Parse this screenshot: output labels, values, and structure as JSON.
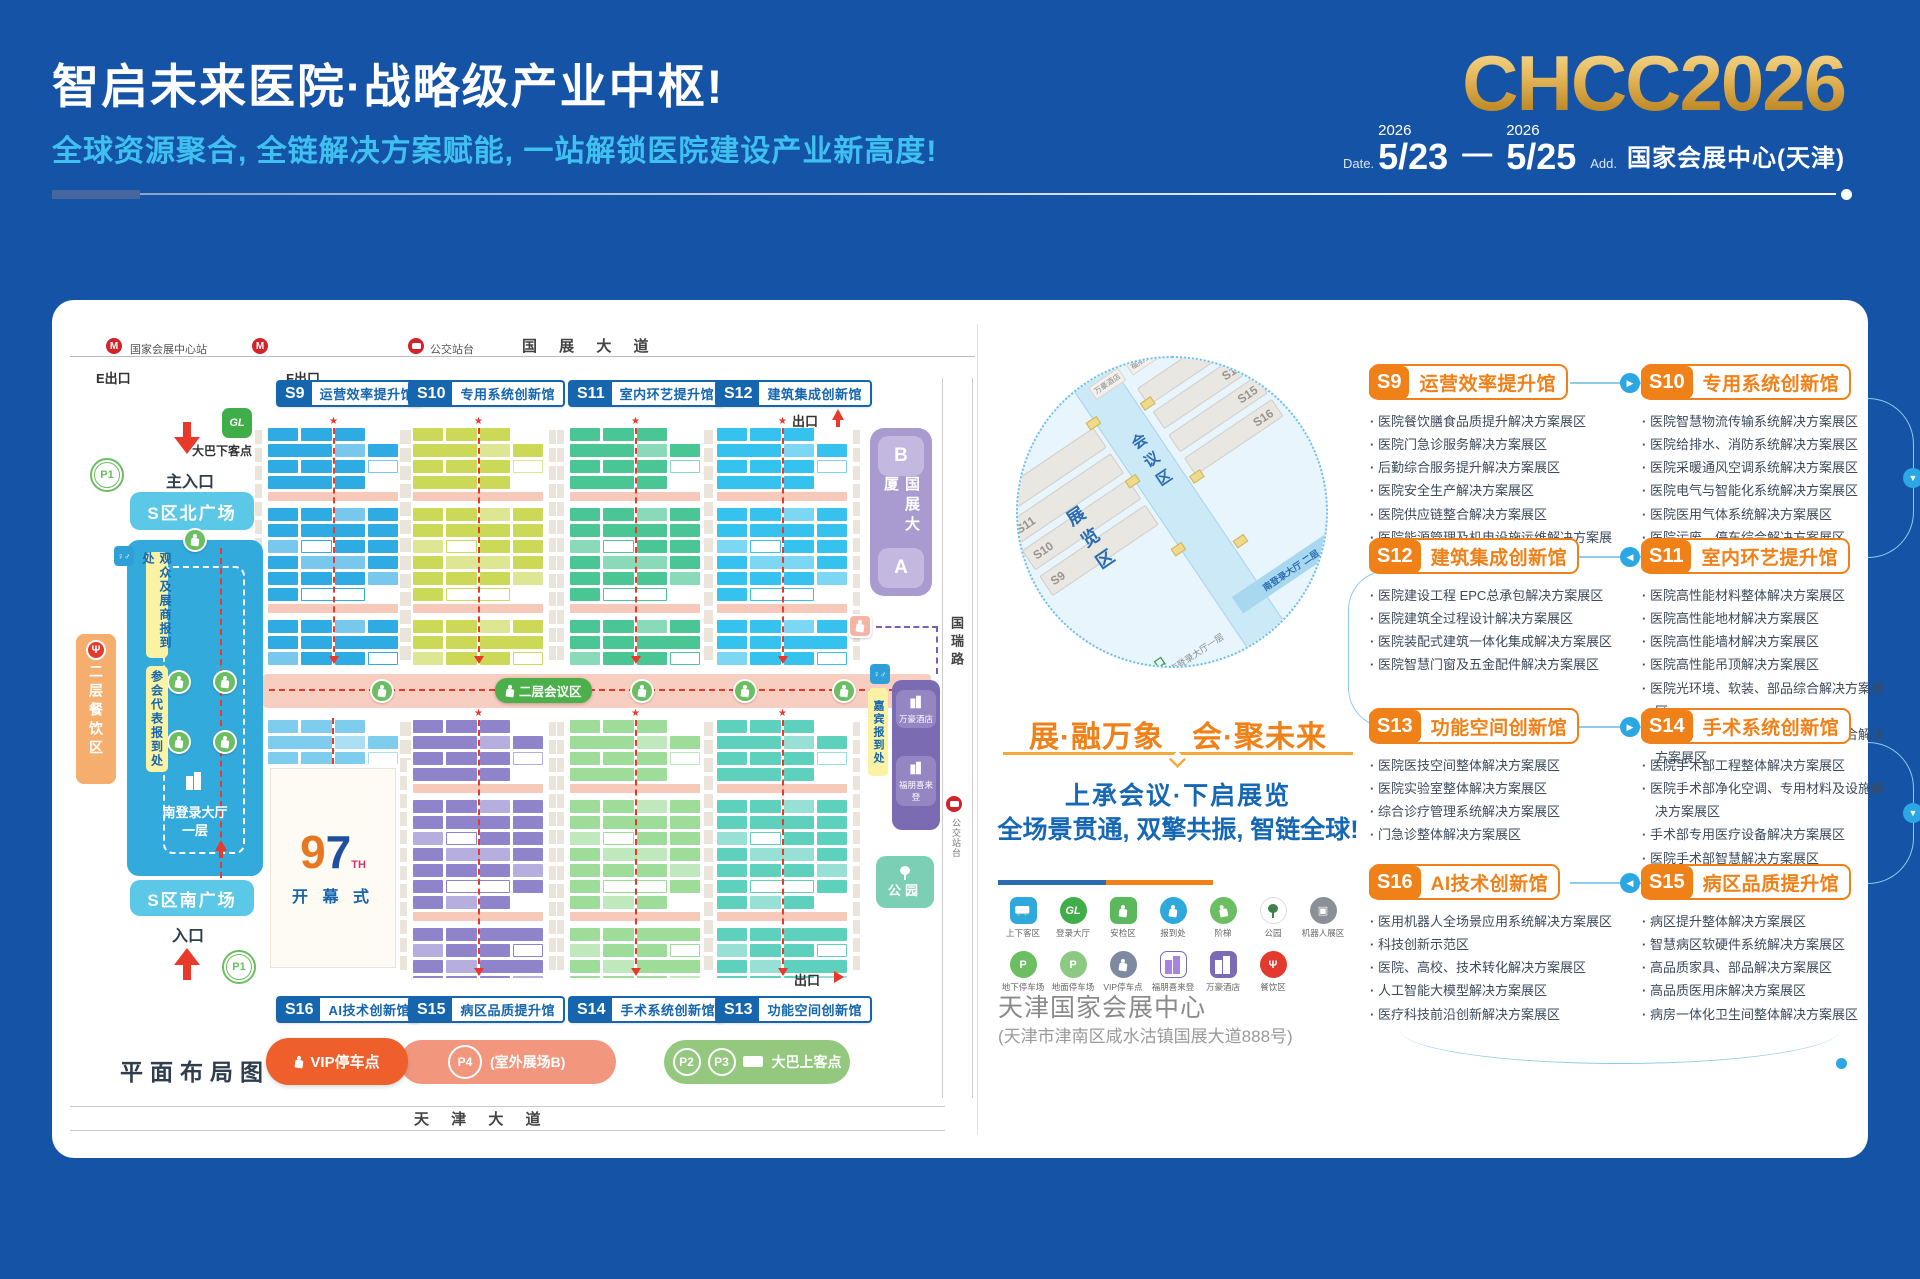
{
  "header": {
    "title": "智启未来医院·战略级产业中枢!",
    "subtitle": "全球资源聚合, 全链解决方案赋能, 一站解锁医院建设产业新高度!",
    "logo": "CHCC2026",
    "date_label": "Date.",
    "year1": "2026",
    "date_start": "5/23",
    "date_sep": "—",
    "year2": "2026",
    "date_end": "5/25",
    "addr_label": "Add.",
    "venue": "国家会展中心(天津)"
  },
  "colors": {
    "accent_orange": "#f08119",
    "accent_blue": "#1565af",
    "gold": "#e3b254",
    "background_blue": "#1553a6"
  },
  "icons": {
    "arrow_right": "▶",
    "arrow_left": "◀",
    "arrow_down": "▼",
    "metro": "M",
    "wc": "♀♂",
    "fork": "Ψ",
    "gl": "GL",
    "p": "P",
    "robot": "▣"
  },
  "map": {
    "station": "国家会展中心站",
    "bus_stop_top": "公交站台",
    "road_top": "国 展 大 道",
    "exit_e": "E出口",
    "exit_f": "F出口",
    "exit_top": "出口",
    "exit_bottom": "出口",
    "halls_top": [
      {
        "id": "S9",
        "name": "运营效率提升馆",
        "color": "#2fabe4"
      },
      {
        "id": "S10",
        "name": "专用系统创新馆",
        "color": "#cbd957"
      },
      {
        "id": "S11",
        "name": "室内环艺提升馆",
        "color": "#4ac694"
      },
      {
        "id": "S12",
        "name": "建筑集成创新馆",
        "color": "#36c2ee"
      }
    ],
    "halls_bottom": [
      {
        "id": "S16",
        "name": "AI技术创新馆",
        "color": "#7fcdee"
      },
      {
        "id": "S15",
        "name": "病区品质提升馆",
        "color": "#8f83cc"
      },
      {
        "id": "S14",
        "name": "手术系统创新馆",
        "color": "#9edc9a"
      },
      {
        "id": "S13",
        "name": "功能空间创新馆",
        "color": "#5ed0be"
      }
    ],
    "left": {
      "main_entrance": "主入口",
      "bus_drop": "大巴下客点",
      "p1": "P1",
      "north_plaza": "S区北广场",
      "reg_visitors": "观众及展商报到处",
      "reg_delegates": "参会代表报到处",
      "dining2f": "二层餐饮区",
      "south_hall_line1": "南登录大厅",
      "south_hall_line2": "一层",
      "south_plaza": "S区南广场",
      "entrance": "入口"
    },
    "center_label": "二层会议区",
    "ceremony": {
      "n9": "9",
      "n7": "7",
      "th": "TH",
      "label": "开 幕 式"
    },
    "right": {
      "tower_b": "B",
      "tower_name": "国展大厦",
      "tower_a": "A",
      "road": "国瑞路",
      "guest_reg": "嘉宾报到处",
      "hotel_marriott": "万豪酒店",
      "hotel_fourpoints": "福朋喜来登",
      "park": "公园",
      "bus_stop_right": "公交站台"
    },
    "legend": {
      "vip": "VIP停车点",
      "p4": "P4",
      "p4_note": "(室外展场B)",
      "p2": "P2",
      "p3": "P3",
      "bus_pickup": "大巴上客点"
    },
    "plan_title": "平面布局图",
    "road_bottom": "天 津 大 道"
  },
  "panel": {
    "circle": {
      "halls_left": [
        "S12",
        "S11",
        "S10",
        "S9"
      ],
      "halls_right": [
        "S13",
        "S14",
        "S15",
        "S16"
      ],
      "zone_exhibit": "展览区",
      "zone_conference": "会议区",
      "hall_2f": "南登录大厅 二层",
      "hall_1f": "南登录大厅一层",
      "main_entrance": "主入口",
      "dining": "餐饮区",
      "hotel1": "万豪酒店",
      "hotel2": "福朋喜来登"
    },
    "slogan_left": "展·融万象",
    "slogan_right": "会·聚未来",
    "sub1": "上承会议·下启展览",
    "sub2": "全场景贯通, 双擎共振, 智链全球!",
    "legend_row1": [
      "上下客区",
      "登录大厅",
      "安检区",
      "报到处",
      "阶梯",
      "公园",
      "机器人展区"
    ],
    "legend_row2": [
      "地下停车场",
      "地面停车场",
      "VIP停车点",
      "福朋喜来登",
      "万豪酒店",
      "餐饮区"
    ],
    "venue_name": "天津国家会展中心",
    "venue_addr": "(天津市津南区咸水沽镇国展大道888号)"
  },
  "hall_details": [
    {
      "id": "S9",
      "name": "运营效率提升馆",
      "items": [
        "医院餐饮膳食品质提升解决方案展区",
        "医院门急诊服务解决方案展区",
        "后勤综合服务提升解决方案展区",
        "医院安全生产解决方案展区",
        "医院供应链整合解决方案展区",
        "医院能源管理及机电设施运维解决方案展区"
      ]
    },
    {
      "id": "S10",
      "name": "专用系统创新馆",
      "items": [
        "医院智慧物流传输系统解决方案展区",
        "医院给排水、消防系统解决方案展区",
        "医院采暖通风空调系统解决方案展区",
        "医院电气与智能化系统解决方案展区",
        "医院医用气体系统解决方案展区",
        "医院污废、停车综合解决方案展区"
      ]
    },
    {
      "id": "S12",
      "name": "建筑集成创新馆",
      "items": [
        "医院建设工程 EPC总承包解决方案展区",
        "医院建筑全过程设计解决方案展区",
        "医院装配式建筑一体化集成解决方案展区",
        "医院智慧门窗及五金配件解决方案展区"
      ]
    },
    {
      "id": "S11",
      "name": "室内环艺提升馆",
      "items": [
        "医院高性能材料整体解决方案展区",
        "医院高性能地材解决方案展区",
        "医院高性能墙材解决方案展区",
        "医院高性能吊顶解决方案展区",
        "医院光环境、软装、部品综合解决方案展区",
        "医院艺术品、标识标牌、无障碍综合解决方案展区"
      ]
    },
    {
      "id": "S13",
      "name": "功能空间创新馆",
      "items": [
        "医院医技空间整体解决方案展区",
        "医院实验室整体解决方案展区",
        "综合诊疗管理系统解决方案展区",
        "门急诊整体解决方案展区"
      ]
    },
    {
      "id": "S14",
      "name": "手术系统创新馆",
      "items": [
        "医院手术部工程整体解决方案展区",
        "医院手术部净化空调、专用材料及设施解决方案展区",
        "手术部专用医疗设备解决方案展区",
        "医院手术部智慧解决方案展区"
      ]
    },
    {
      "id": "S16",
      "name": "AI技术创新馆",
      "items": [
        "医用机器人全场景应用系统解决方案展区",
        "科技创新示范区",
        "医院、高校、技术转化解决方案展区",
        "人工智能大模型解决方案展区",
        "医疗科技前沿创新解决方案展区"
      ]
    },
    {
      "id": "S15",
      "name": "病区品质提升馆",
      "items": [
        "病区提升整体解决方案展区",
        "智慧病区软硬件系统解决方案展区",
        "高品质家具、部品解决方案展区",
        "高品质医用床解决方案展区",
        "病房一体化卫生间整体解决方案展区"
      ]
    }
  ]
}
